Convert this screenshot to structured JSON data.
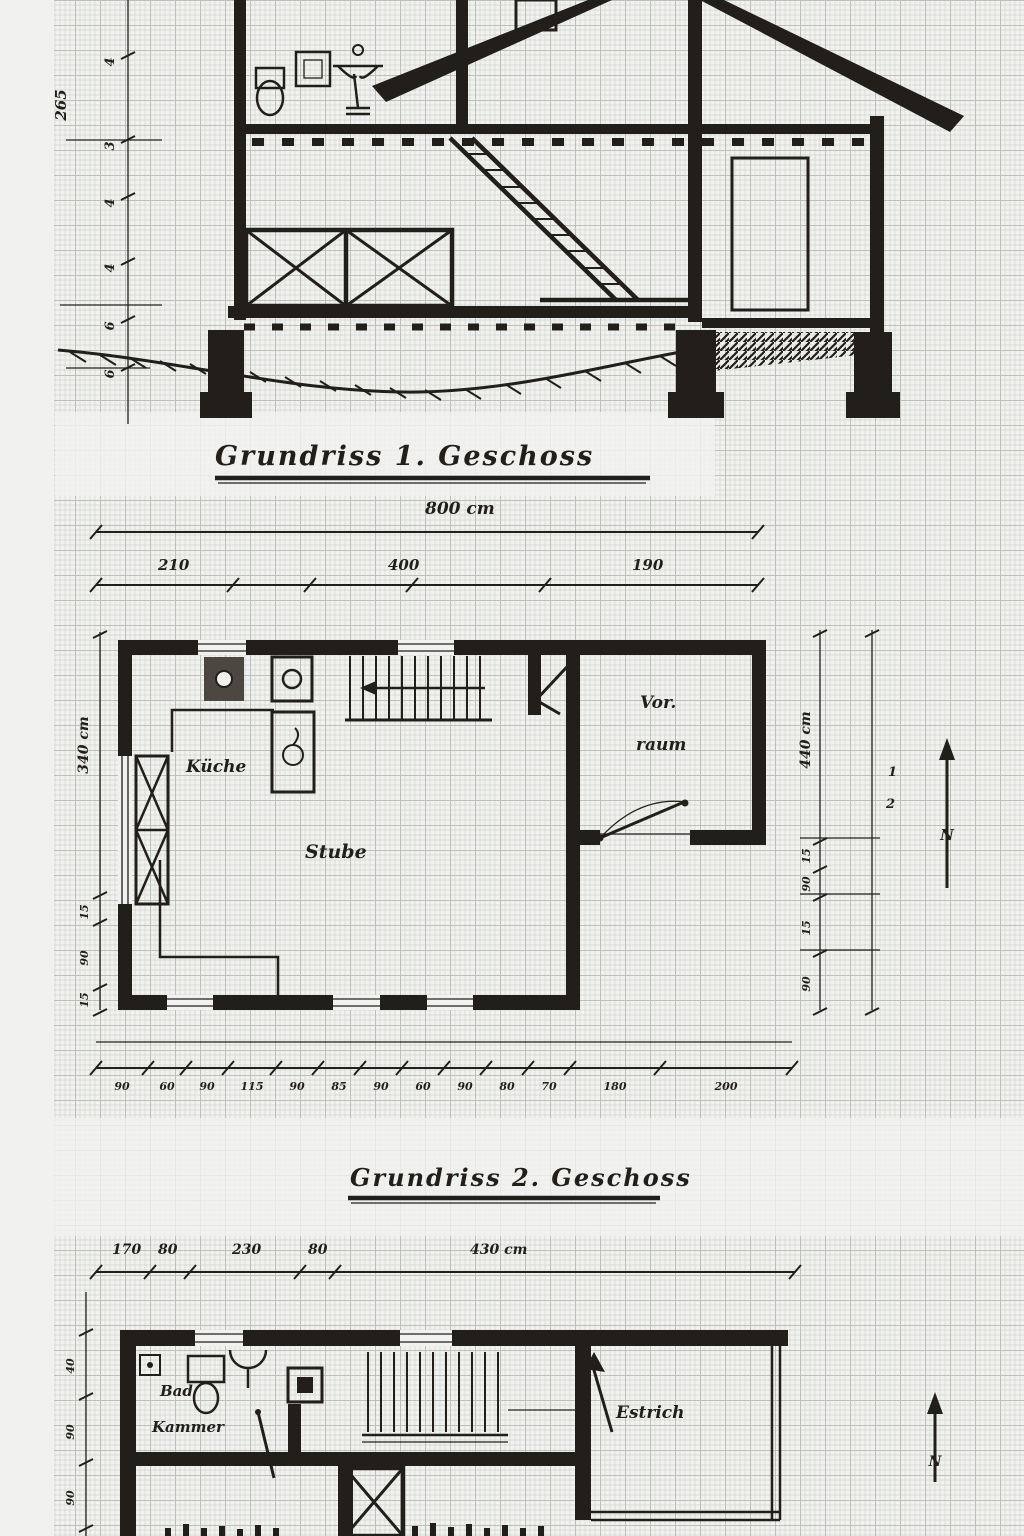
{
  "colors": {
    "paper": "#f5f5f2",
    "ink": "#1f1c18",
    "grid_minor": "#cfd3ce",
    "grid_major": "#b4b8b3"
  },
  "cross_section": {
    "left_height_label": "265",
    "left_chain": [
      "4",
      "3",
      "4",
      "4",
      "6",
      "6"
    ]
  },
  "plan1": {
    "title": "Grundriss 1. Geschoss",
    "total_width": "800 cm",
    "top_segments": [
      "210",
      "400",
      "190"
    ],
    "left_total": "340 cm",
    "left_chain": [
      "15",
      "90",
      "15"
    ],
    "right_total": "440 cm",
    "right_chain": [
      "15",
      "90",
      "15",
      "90"
    ],
    "right_note_top": "1",
    "right_note_bottom": "2",
    "rooms": {
      "kitchen": "Küche",
      "living": "Stube",
      "hall_line1": "Vor.",
      "hall_line2": "raum"
    },
    "north": "N",
    "bottom_chain": [
      "90",
      "60",
      "90",
      "115",
      "90",
      "85",
      "90",
      "60",
      "90",
      "80",
      "70",
      "180",
      "200"
    ]
  },
  "plan2": {
    "title": "Grundriss 2. Geschoss",
    "top_segments": [
      "170",
      "80",
      "230",
      "80",
      "430 cm"
    ],
    "left_chain": [
      "40",
      "90",
      "90"
    ],
    "rooms": {
      "bath_line1": "Bad",
      "bath_line2": "Kammer",
      "attic": "Estrich"
    },
    "north": "N"
  }
}
